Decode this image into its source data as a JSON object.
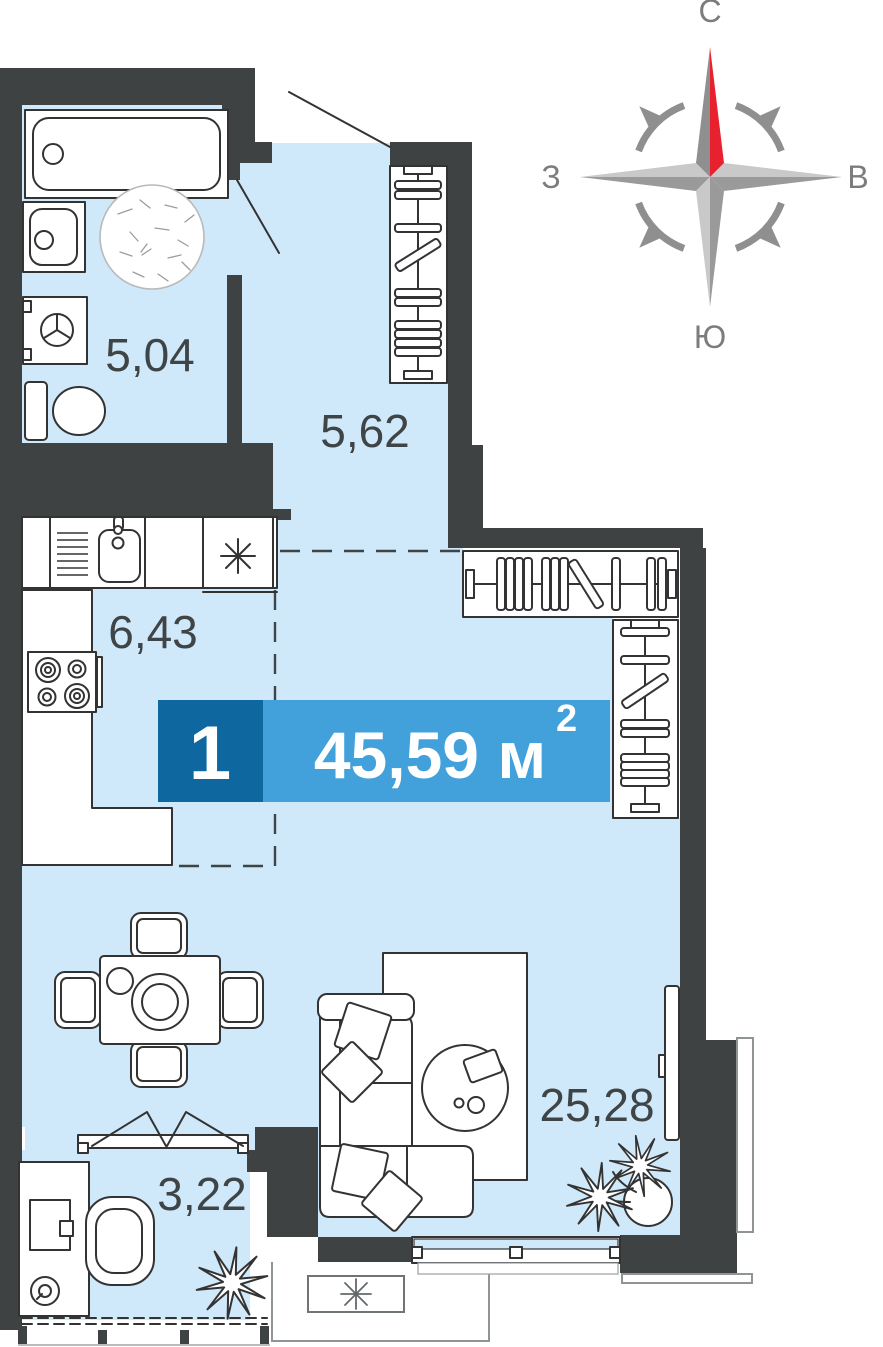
{
  "plan": {
    "unit": {
      "rooms_count": "1",
      "area_value": "45,59 м",
      "area_exponent": "2",
      "area_full": "45,59 м²"
    },
    "rooms": {
      "bathroom": {
        "area": "5,04"
      },
      "hallway": {
        "area": "5,62"
      },
      "kitchen": {
        "area": "6,43"
      },
      "living_room": {
        "area": "25,28"
      },
      "balcony": {
        "area": "3,22"
      }
    }
  },
  "compass": {
    "north": "С",
    "south": "Ю",
    "west": "З",
    "east": "В"
  },
  "symbols": {
    "fridge_marker": "asterisk",
    "ac_unit_marker": "asterisk"
  },
  "colors": {
    "wall": "#3E4242",
    "floor": "#CFE9FA",
    "banner": "#42A0DB",
    "banner_dark": "#0E679E",
    "compass_red": "#E8212E",
    "outline": "#333333",
    "label": "#3F4547"
  }
}
